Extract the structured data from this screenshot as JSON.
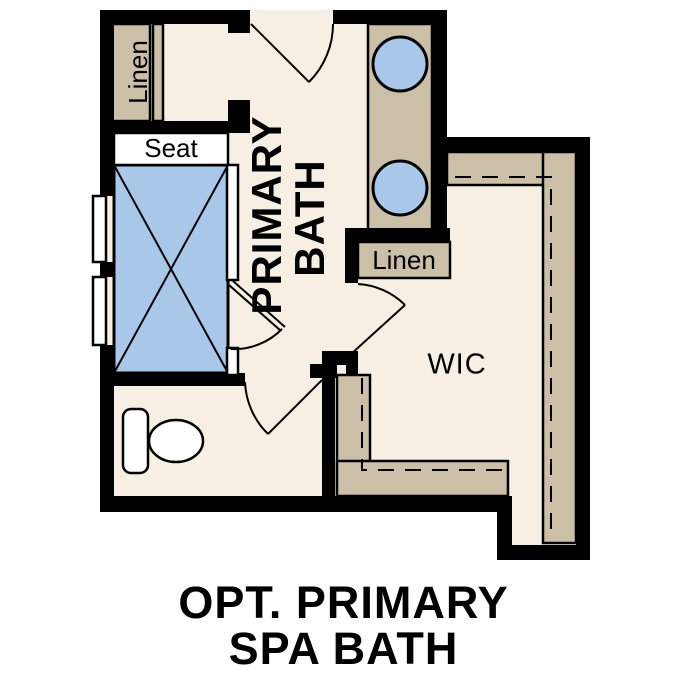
{
  "plan": {
    "rooms": {
      "primary_bath_line1": "PRIMARY",
      "primary_bath_line2": "BATH",
      "wic": "WIC"
    },
    "fixtures": {
      "linen_closet_top": "Linen",
      "linen_closet_right": "Linen",
      "shower_seat": "Seat"
    }
  },
  "caption": {
    "line1": "OPT. PRIMARY",
    "line2": "SPA BATH"
  },
  "colors": {
    "floor": "#f7efe4",
    "wall": "#000000",
    "cabinet_tan": "#cbbfa8",
    "fixture_blue": "#a9c8e9",
    "fixture_white": "#ffffff",
    "ink": "#000000"
  }
}
